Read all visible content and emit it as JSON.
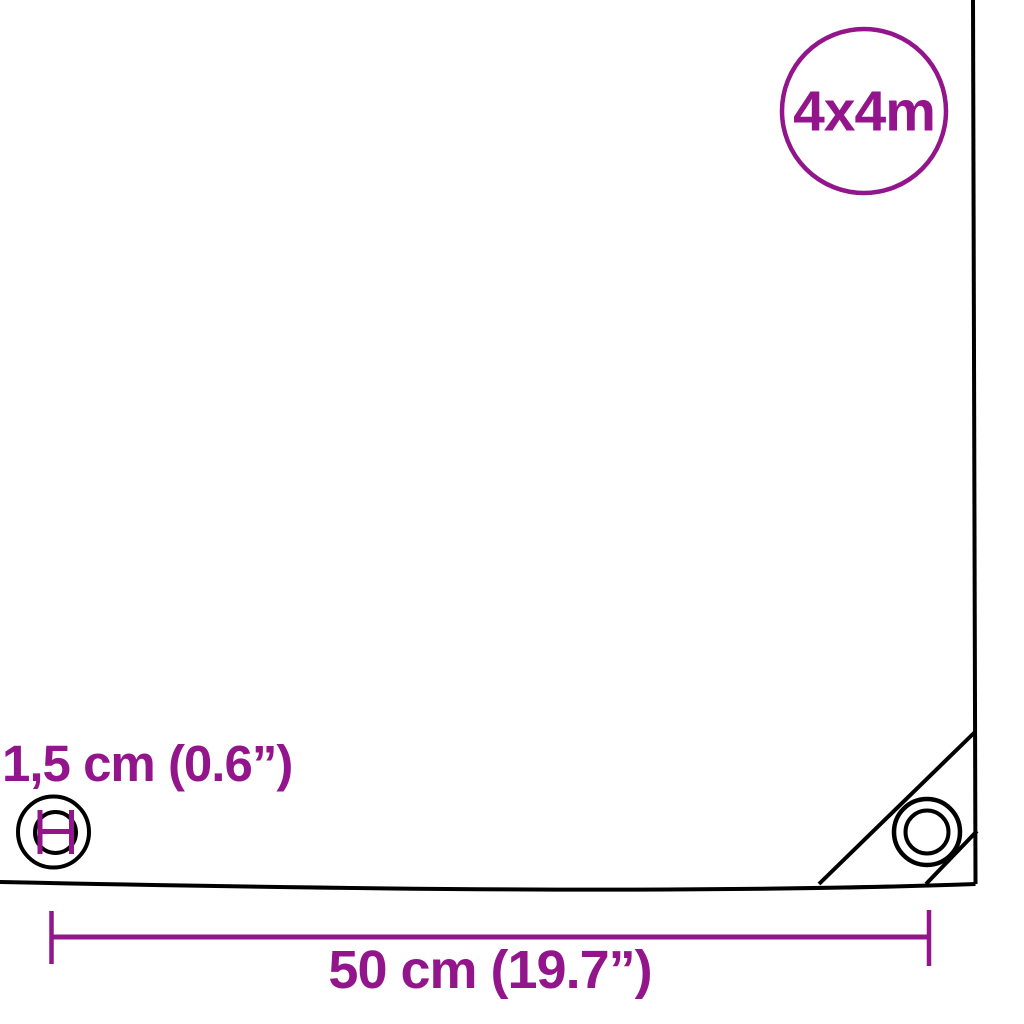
{
  "badge": {
    "label": "4x4m"
  },
  "labels": {
    "grommet_diameter": "1,5 cm (0.6”)",
    "grommet_spacing": "50 cm (19.7”)"
  },
  "colors": {
    "accent_purple": "#93158b",
    "line_black": "#000000",
    "background": "#ffffff"
  },
  "icons": {
    "grommet_diameter_icon": "double circle with purple H-shaped diameter measurement mark",
    "corner_grommet_icon": "concentric circles grommet inside reinforced corner triangle",
    "size_badge_circle": "purple outlined circle containing tarp size"
  }
}
